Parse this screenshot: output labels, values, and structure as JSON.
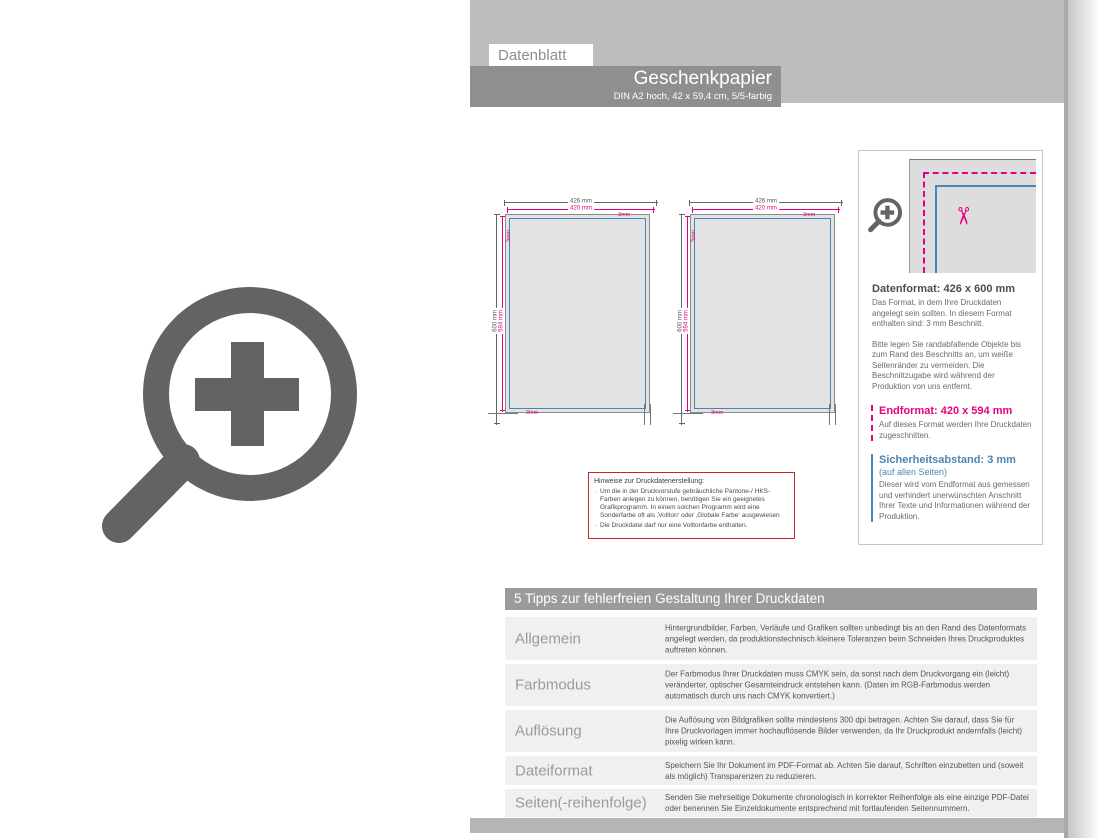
{
  "header": {
    "tab": "Datenblatt",
    "title": "Geschenkpapier",
    "subtitle": "DIN A2 hoch, 42 x 59,4 cm, 5/5-farbig"
  },
  "diagram": {
    "width_outer": "426 mm",
    "width_inner": "420 mm",
    "height_outer": "600 mm",
    "height_inner": "594 mm",
    "bleed": "3mm"
  },
  "detail": {
    "datenformat_title": "Datenformat: 426 x 600 mm",
    "datenformat_p1": "Das Format, in dem Ihre Druckdaten angelegt sein sollten. In diesem Format enthalten sind: 3 mm Beschnitt.",
    "datenformat_p2": "Bitte legen Sie randabfallende Objekte bis zum Rand des Beschnitts an, um weiße Seitenränder zu vermeiden. Die Beschnittzugabe wird während der Produktion von uns entfernt.",
    "endformat_title": "Endformat: 420 x 594 mm",
    "endformat_p": "Auf dieses Format werden Ihre Druckdaten zugeschnitten.",
    "sicherheit_title": "Sicherheitsabstand: 3 mm",
    "sicherheit_sub": "(auf allen Seiten)",
    "sicherheit_p": "Dieser wird vom Endformat aus gemessen und verhindert unerwünschten Anschnitt Ihrer Texte und Informationen während der Produktion."
  },
  "hinweise": {
    "title": "Hinweise zur Druckdatenerstellung:",
    "items": [
      "Um die in der Druckvorstufe gebräuchliche Pantone-/ HKS-Farben anlegen zu können, benötigen Sie ein geeignetes Grafikprogramm. In einem solchen Programm wird eine Sonderfarbe oft als ‚Vollton‘ oder ‚Globale Farbe‘ ausgewiesen",
      "Die Druckdatei darf nur eine Volltonfarbe enthalten."
    ]
  },
  "tips": {
    "title": "5 Tipps zur fehlerfreien Gestaltung Ihrer Druckdaten",
    "rows": [
      {
        "label": "Allgemein",
        "text": "Hintergrundbilder, Farben, Verläufe und Grafiken sollten unbedingt bis an den Rand des Datenformats angelegt werden, da produktionstechnisch kleinere Toleranzen beim Schneiden Ihres Druckproduktes auftreten können."
      },
      {
        "label": "Farbmodus",
        "text": "Der Farbmodus Ihrer Druckdaten muss CMYK sein, da sonst nach dem Druckvorgang ein (leicht) veränderter, optischer Gesamteindruck entstehen kann. (Daten im RGB-Farbmodus werden automatisch durch uns nach CMYK konvertiert.)"
      },
      {
        "label": "Auflösung",
        "text": "Die Auflösung von Bildgrafiken sollte mindestens 300 dpi betragen. Achten Sie darauf, dass Sie für Ihre Druckvorlagen immer hochauflösende Bilder verwenden, da Ihr Druckprodukt andernfalls (leicht) pixelig wirken kann."
      },
      {
        "label": "Dateiformat",
        "text": "Speichern Sie Ihr Dokument im PDF-Format ab. Achten Sie darauf, Schriften einzubetten und (soweit als möglich) Transparenzen zu reduzieren."
      },
      {
        "label": "Seiten(-reihenfolge)",
        "text": "Senden Sie mehrseitige Dokumente chronologisch in korrekter Reihenfolge als eine einzige PDF-Datei oder benennen Sie Einzeldokumente entsprechend mit fortlaufenden Seitennummern."
      }
    ]
  },
  "icons": {
    "zoom_plus_large": "zoom-plus-icon",
    "zoom_plus_small": "zoom-plus-icon",
    "scissors": "scissors-icon"
  },
  "colors": {
    "magenta_endformat": "#e6007e",
    "blue_safety": "#4a86b5",
    "red_hinweis_border": "#c42430",
    "gray_header": "#bdbdbd",
    "gray_title_bar": "#8f8f8f",
    "gray_icon": "#636363"
  }
}
